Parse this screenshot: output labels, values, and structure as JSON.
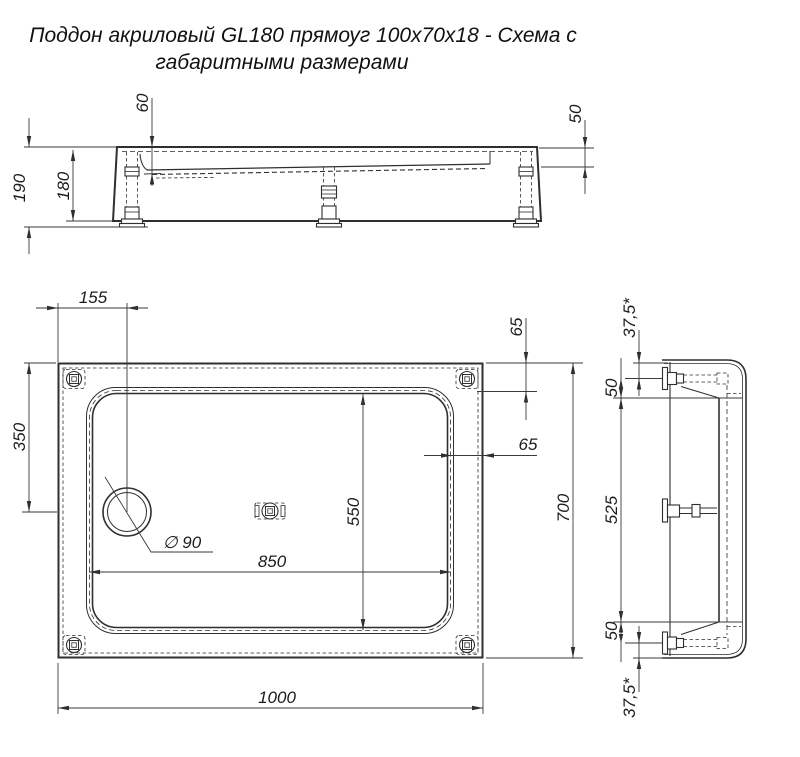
{
  "title": {
    "line1": "Поддон акриловый  GL180 прямоуг 100х70х18 - Схема с",
    "line2": "габаритными размерами"
  },
  "front_view": {
    "basin_depth": "60",
    "rim_height": "50",
    "height_total": "190",
    "body_height": "180"
  },
  "plan_view": {
    "drain_offset_x": "155",
    "drain_offset_y": "350",
    "rim_top": "65",
    "rim_side": "65",
    "basin_width": "550",
    "basin_length": "850",
    "total_width": "700",
    "total_length": "1000",
    "drain_diameter": "∅ 90"
  },
  "side_view": {
    "margin_top": "37,5*",
    "leg_offset_top": "50",
    "leg_spacing": "525",
    "leg_offset_bottom": "50",
    "margin_bottom": "37,5*"
  },
  "colors": {
    "line": "#2f2f2f",
    "text": "#1c1c1c",
    "background": "#ffffff"
  }
}
